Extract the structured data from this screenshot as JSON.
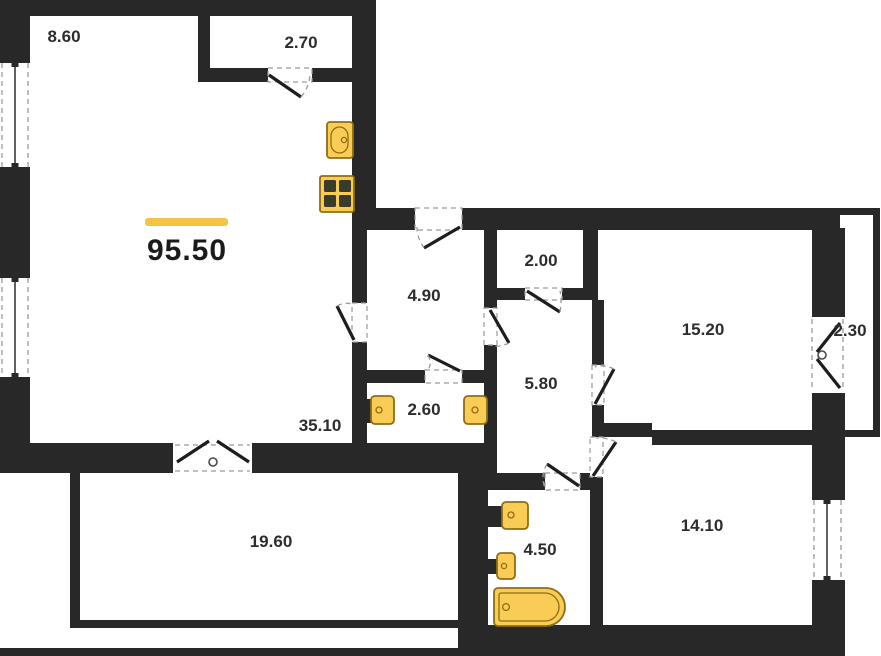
{
  "floorplan": {
    "total_area": "95.50",
    "rooms": {
      "room_top_left": "8.60",
      "closet_top": "2.70",
      "entry_hall": "4.90",
      "storage": "2.00",
      "bedroom_right": "15.20",
      "balcony_right": "2.30",
      "corridor": "5.80",
      "wc": "2.60",
      "living_area": "35.10",
      "bedroom_bottom": "14.10",
      "terrace": "19.60",
      "bathroom": "4.50"
    },
    "fixtures": [
      "kitchen-sink",
      "stove",
      "washbasin",
      "toilet",
      "washbasin",
      "toilet",
      "bathtub"
    ],
    "colors": {
      "accent": "#F5C445",
      "wall": "#282828",
      "fixture_fill": "#F8CC55",
      "fixture_border": "#8F6D14"
    }
  }
}
